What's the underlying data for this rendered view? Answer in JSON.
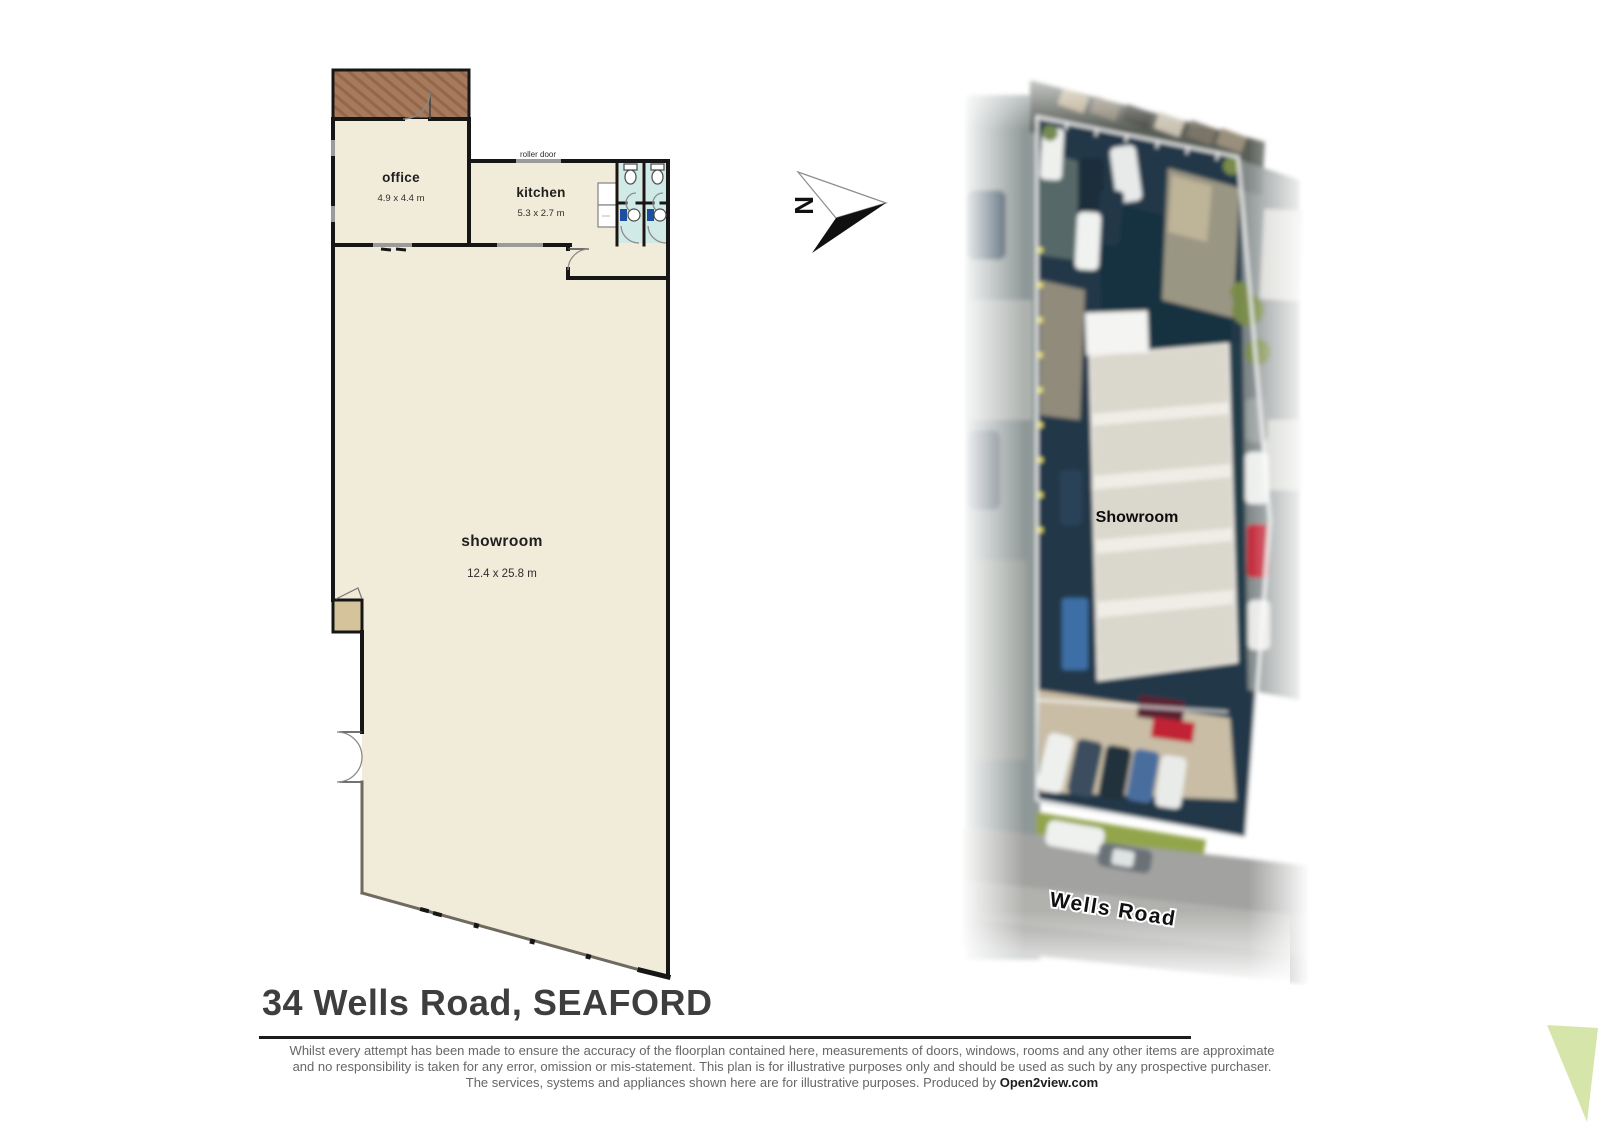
{
  "floorplan": {
    "office_label": "office",
    "office_dims": "4.9 x 4.4 m",
    "kitchen_label": "kitchen",
    "kitchen_dims": "5.3 x 2.7 m",
    "showroom_label": "showroom",
    "showroom_dims": "12.4 x 25.8 m",
    "roller_door_label": "roller door"
  },
  "compass": {
    "north_label": "N"
  },
  "aerial": {
    "building_label": "Showroom",
    "road_label": "Wells Road"
  },
  "footer": {
    "title": "34 Wells Road, SEAFORD",
    "disclaimer_line1": "Whilst every attempt has been made to ensure the accuracy of the floorplan contained here, measurements of doors, windows, rooms and any other items are approximate",
    "disclaimer_line2": "and no responsibility is taken for any error, omission or mis-statement.  This plan is for illustrative purposes only and should be used as such by any prospective purchaser.",
    "disclaimer_line3_prefix": "The services, systems and appliances shown here are for illustrative purposes.   Produced by ",
    "brand": "Open2view.com"
  },
  "colors": {
    "floor": "#f1ebd9",
    "wall": "#161616",
    "deck": "#a87a5c",
    "deck_stripe": "#8a6148",
    "opening": "#9b9b9b",
    "toilet_floor": "#cfeae7",
    "fixture_blue": "#1d4fa0",
    "alcove": "#d5c39c",
    "parking": "#20394a",
    "roof": "#dad7cc",
    "road": "#a2a2a0",
    "grass": "#93a54b",
    "red_car": "#c22334",
    "boundary_line": "#ffffff",
    "corner_accent": "#d6e5aa",
    "title_text": "#3e3e3e",
    "disclaimer_text": "#666666"
  }
}
